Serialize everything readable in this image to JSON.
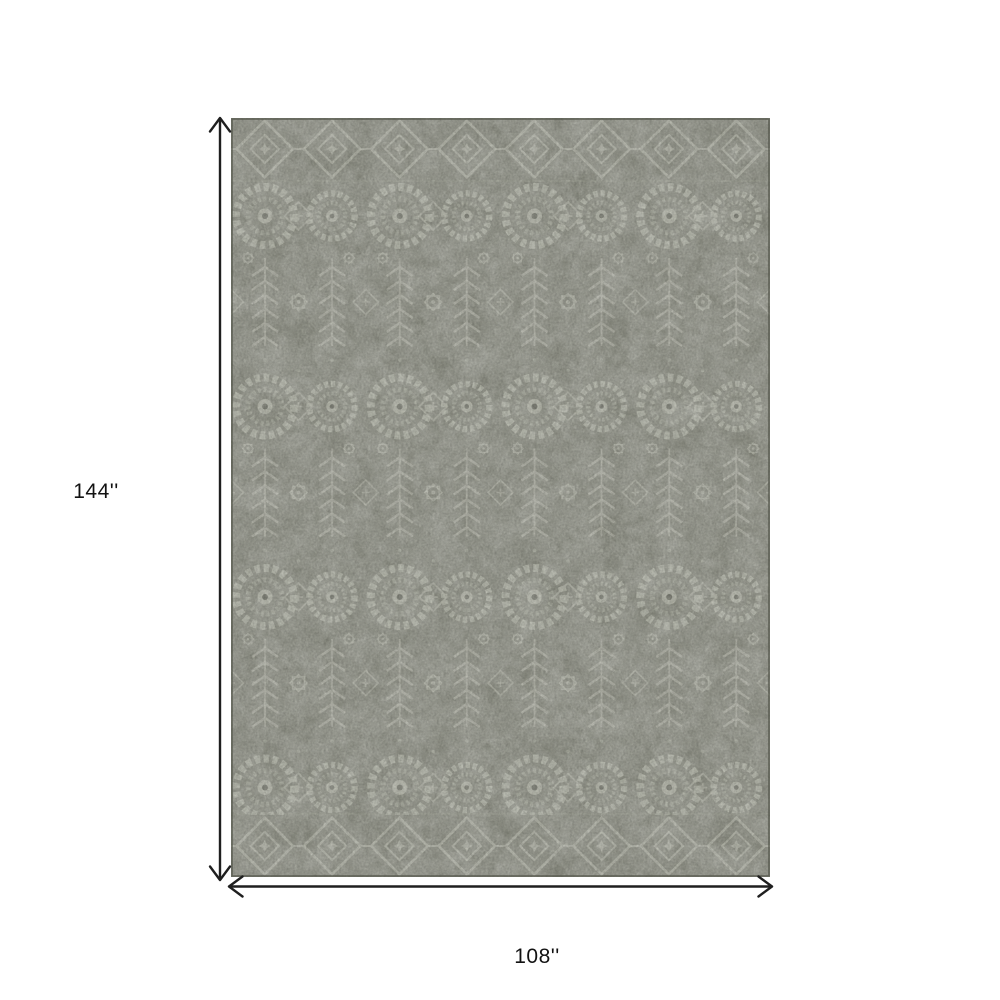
{
  "diagram": {
    "height_label": "144''",
    "width_label": "108''",
    "arrow_color": "#1f1f1f",
    "label_color": "#121212",
    "background_color": "#ffffff",
    "rug": {
      "base_color": "#95978a",
      "motif_light": "#c7c9ba",
      "motif_mid": "#b4b6a7",
      "motif_dark": "#74766a",
      "edge_color": "#53554a"
    }
  }
}
